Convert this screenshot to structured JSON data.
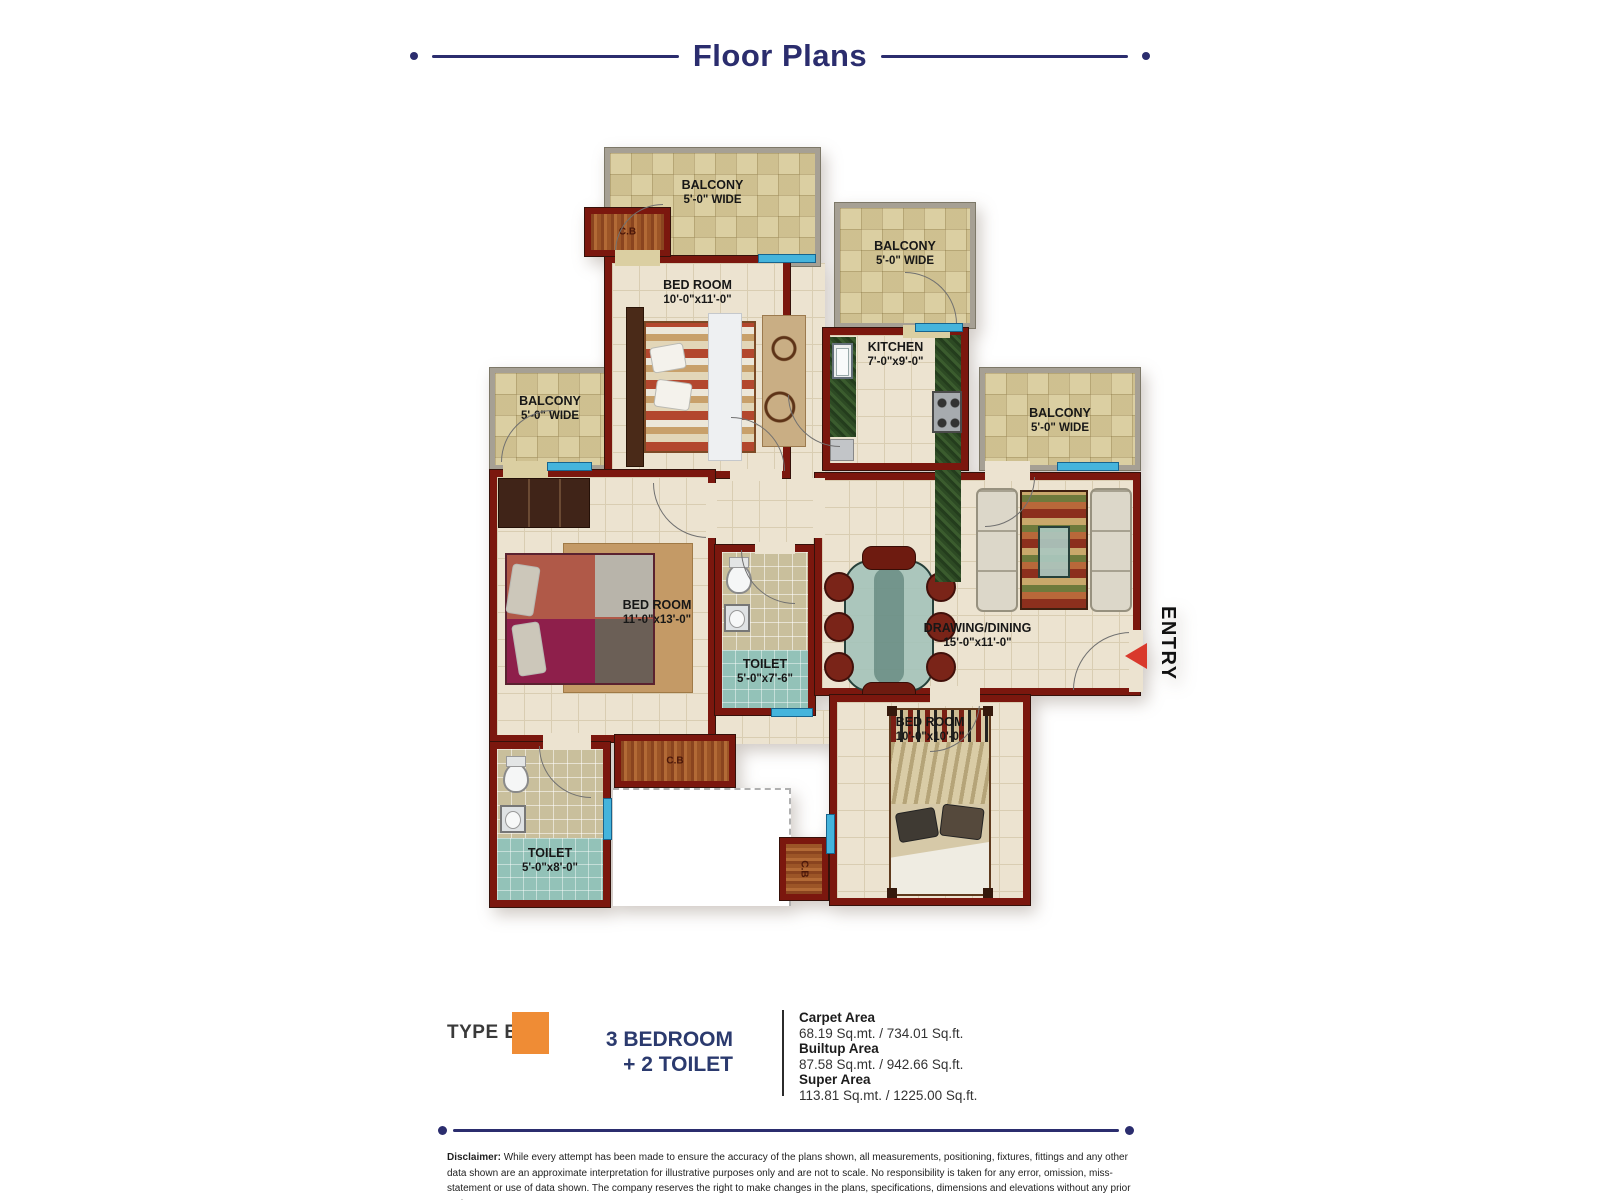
{
  "header": {
    "title": "Floor Plans"
  },
  "plan": {
    "entry_label": "ENTRY",
    "cupboard_label": "C.B",
    "rooms": [
      {
        "name": "BALCONY",
        "dim": "5'-0\" WIDE"
      },
      {
        "name": "BALCONY",
        "dim": "5'-0\" WIDE"
      },
      {
        "name": "BED ROOM",
        "dim": "10'-0\"x11'-0\""
      },
      {
        "name": "KITCHEN",
        "dim": "7'-0\"x9'-0\""
      },
      {
        "name": "BALCONY",
        "dim": "5'-0\" WIDE"
      },
      {
        "name": "BALCONY",
        "dim": "5'-0\" WIDE"
      },
      {
        "name": "BED ROOM",
        "dim": "11'-0\"x13'-0\""
      },
      {
        "name": "TOILET",
        "dim": "5'-0\"x7'-6\""
      },
      {
        "name": "DRAWING/DINING",
        "dim": "15'-0\"x11'-0\""
      },
      {
        "name": "BED ROOM",
        "dim": "10'-0\"x10'-0\""
      },
      {
        "name": "TOILET",
        "dim": "5'-0\"x8'-0\""
      }
    ]
  },
  "summary": {
    "type_label": "TYPE B",
    "config_line1": "3 BEDROOM",
    "config_line2": "+ 2 TOILET",
    "areas": [
      {
        "label": "Carpet Area",
        "value": "68.19 Sq.mt. / 734.01 Sq.ft."
      },
      {
        "label": "Builtup Area",
        "value": "87.58 Sq.mt. / 942.66 Sq.ft."
      },
      {
        "label": "Super Area",
        "value": "113.81 Sq.mt. / 1225.00 Sq.ft."
      }
    ]
  },
  "footer": {
    "disclaimer_label": "Disclaimer:",
    "disclaimer_text": " While every attempt has been made to ensure the accuracy of the plans shown, all measurements, positioning, fixtures, fittings and any other data shown are an approximate interpretation for illustrative purposes only and are not to scale. No responsibility is taken for any error, omission, miss-statement or use of data shown. The company reserves the right to make changes in the plans, specifications, dimensions and elevations without any prior notice."
  },
  "colors": {
    "accent_orange": "#EF8C35",
    "title_navy": "#2B2D6E",
    "wall_maroon": "#7B170E",
    "window_blue": "#45B4DC",
    "entry_red": "#D9392C"
  }
}
